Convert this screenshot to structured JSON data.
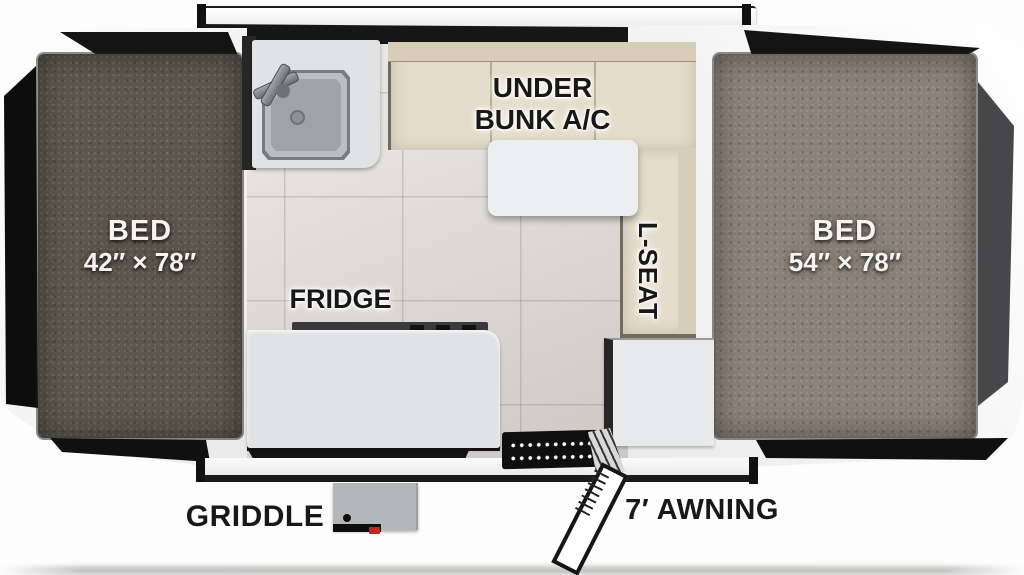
{
  "labels": {
    "front_bed_title": "BED",
    "front_bed_dims": "42″ × 78″",
    "rear_bed_title": "BED",
    "rear_bed_dims": "54″ × 78″",
    "under_bunk_line1": "UNDER",
    "under_bunk_line2": "BUNK A/C",
    "l_seat": "L-SEAT",
    "fridge": "FRIDGE",
    "griddle": "GRIDDLE",
    "awning": "7′ AWNING"
  },
  "colors": {
    "front_bed_mattress": "#5d564e",
    "rear_bed_mattress": "#8a8177",
    "dinette_cushion": "#e4dcca",
    "dinette_cushion_back": "#d7ceb9",
    "floor_tile": "#d8d4cf",
    "fixture_light": "#e0e2e4",
    "table_top": "#edeeef",
    "canvas_dark": "#141414",
    "canvas_gray": "#47474a",
    "griddle_red": "#c4271d"
  }
}
